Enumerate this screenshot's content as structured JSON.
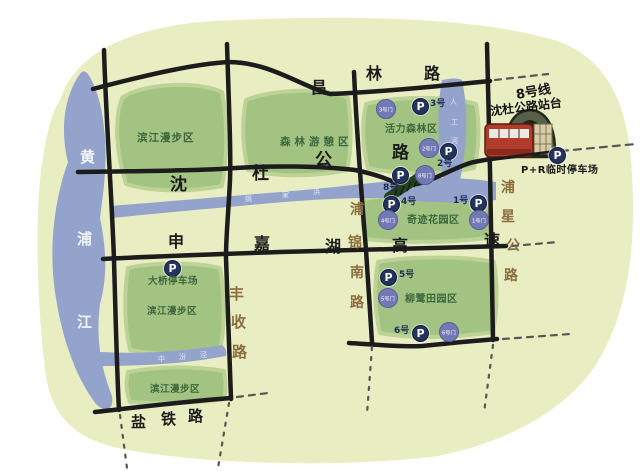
{
  "colors": {
    "land": "#e9eec2",
    "park_green": "#a3c383",
    "park_halo": "#bdd296",
    "water_blue": "#94a3cb",
    "road_black": "#1c1c1c",
    "road_label_brown": "#8a6e40",
    "zone_label_green": "#3c663c",
    "parking_navy": "#25335f",
    "gate_purple": "#7379b4",
    "train_red": "#b23b2b"
  },
  "river": {
    "name": "黄浦江"
  },
  "creeks": {
    "main": "姚家浜",
    "north_band": "人工河",
    "south_branch": "中汾泾"
  },
  "roads": {
    "changlin": "昌林路",
    "shendu": "沈杜公路",
    "shenjiahu": "申嘉湖高速",
    "pujinnan": "浦锦南路",
    "puxing": "浦星公路",
    "fengshou": "丰收路",
    "yantie": "盐铁路"
  },
  "zones": {
    "binjiang_north": "滨江漫步区",
    "forest_recreation": "森林游憩区",
    "vitality_forest": "活力森林区",
    "miracle_garden": "奇迹花园区",
    "willow_field": "柳鹭田园区",
    "binjiang_mid": "滨江漫步区",
    "binjiang_south": "滨江漫步区"
  },
  "metro": {
    "line": "8号线",
    "station": "沈杜公路站台"
  },
  "parking": {
    "p_symbol": "P",
    "lots": {
      "no1": "1号",
      "no2": "2号",
      "no3": "3号",
      "no4": "4号",
      "no5": "5号",
      "no6": "6号",
      "no8": "8号"
    },
    "bridge_lot": "大桥停车场",
    "park_and_ride": "P+R临时停车场"
  },
  "gates": {
    "g1": "1号门",
    "g2": "2号门",
    "g3": "3号门",
    "g4": "4号门",
    "g5": "5号门",
    "g6": "6号门",
    "g8": "8号门"
  }
}
